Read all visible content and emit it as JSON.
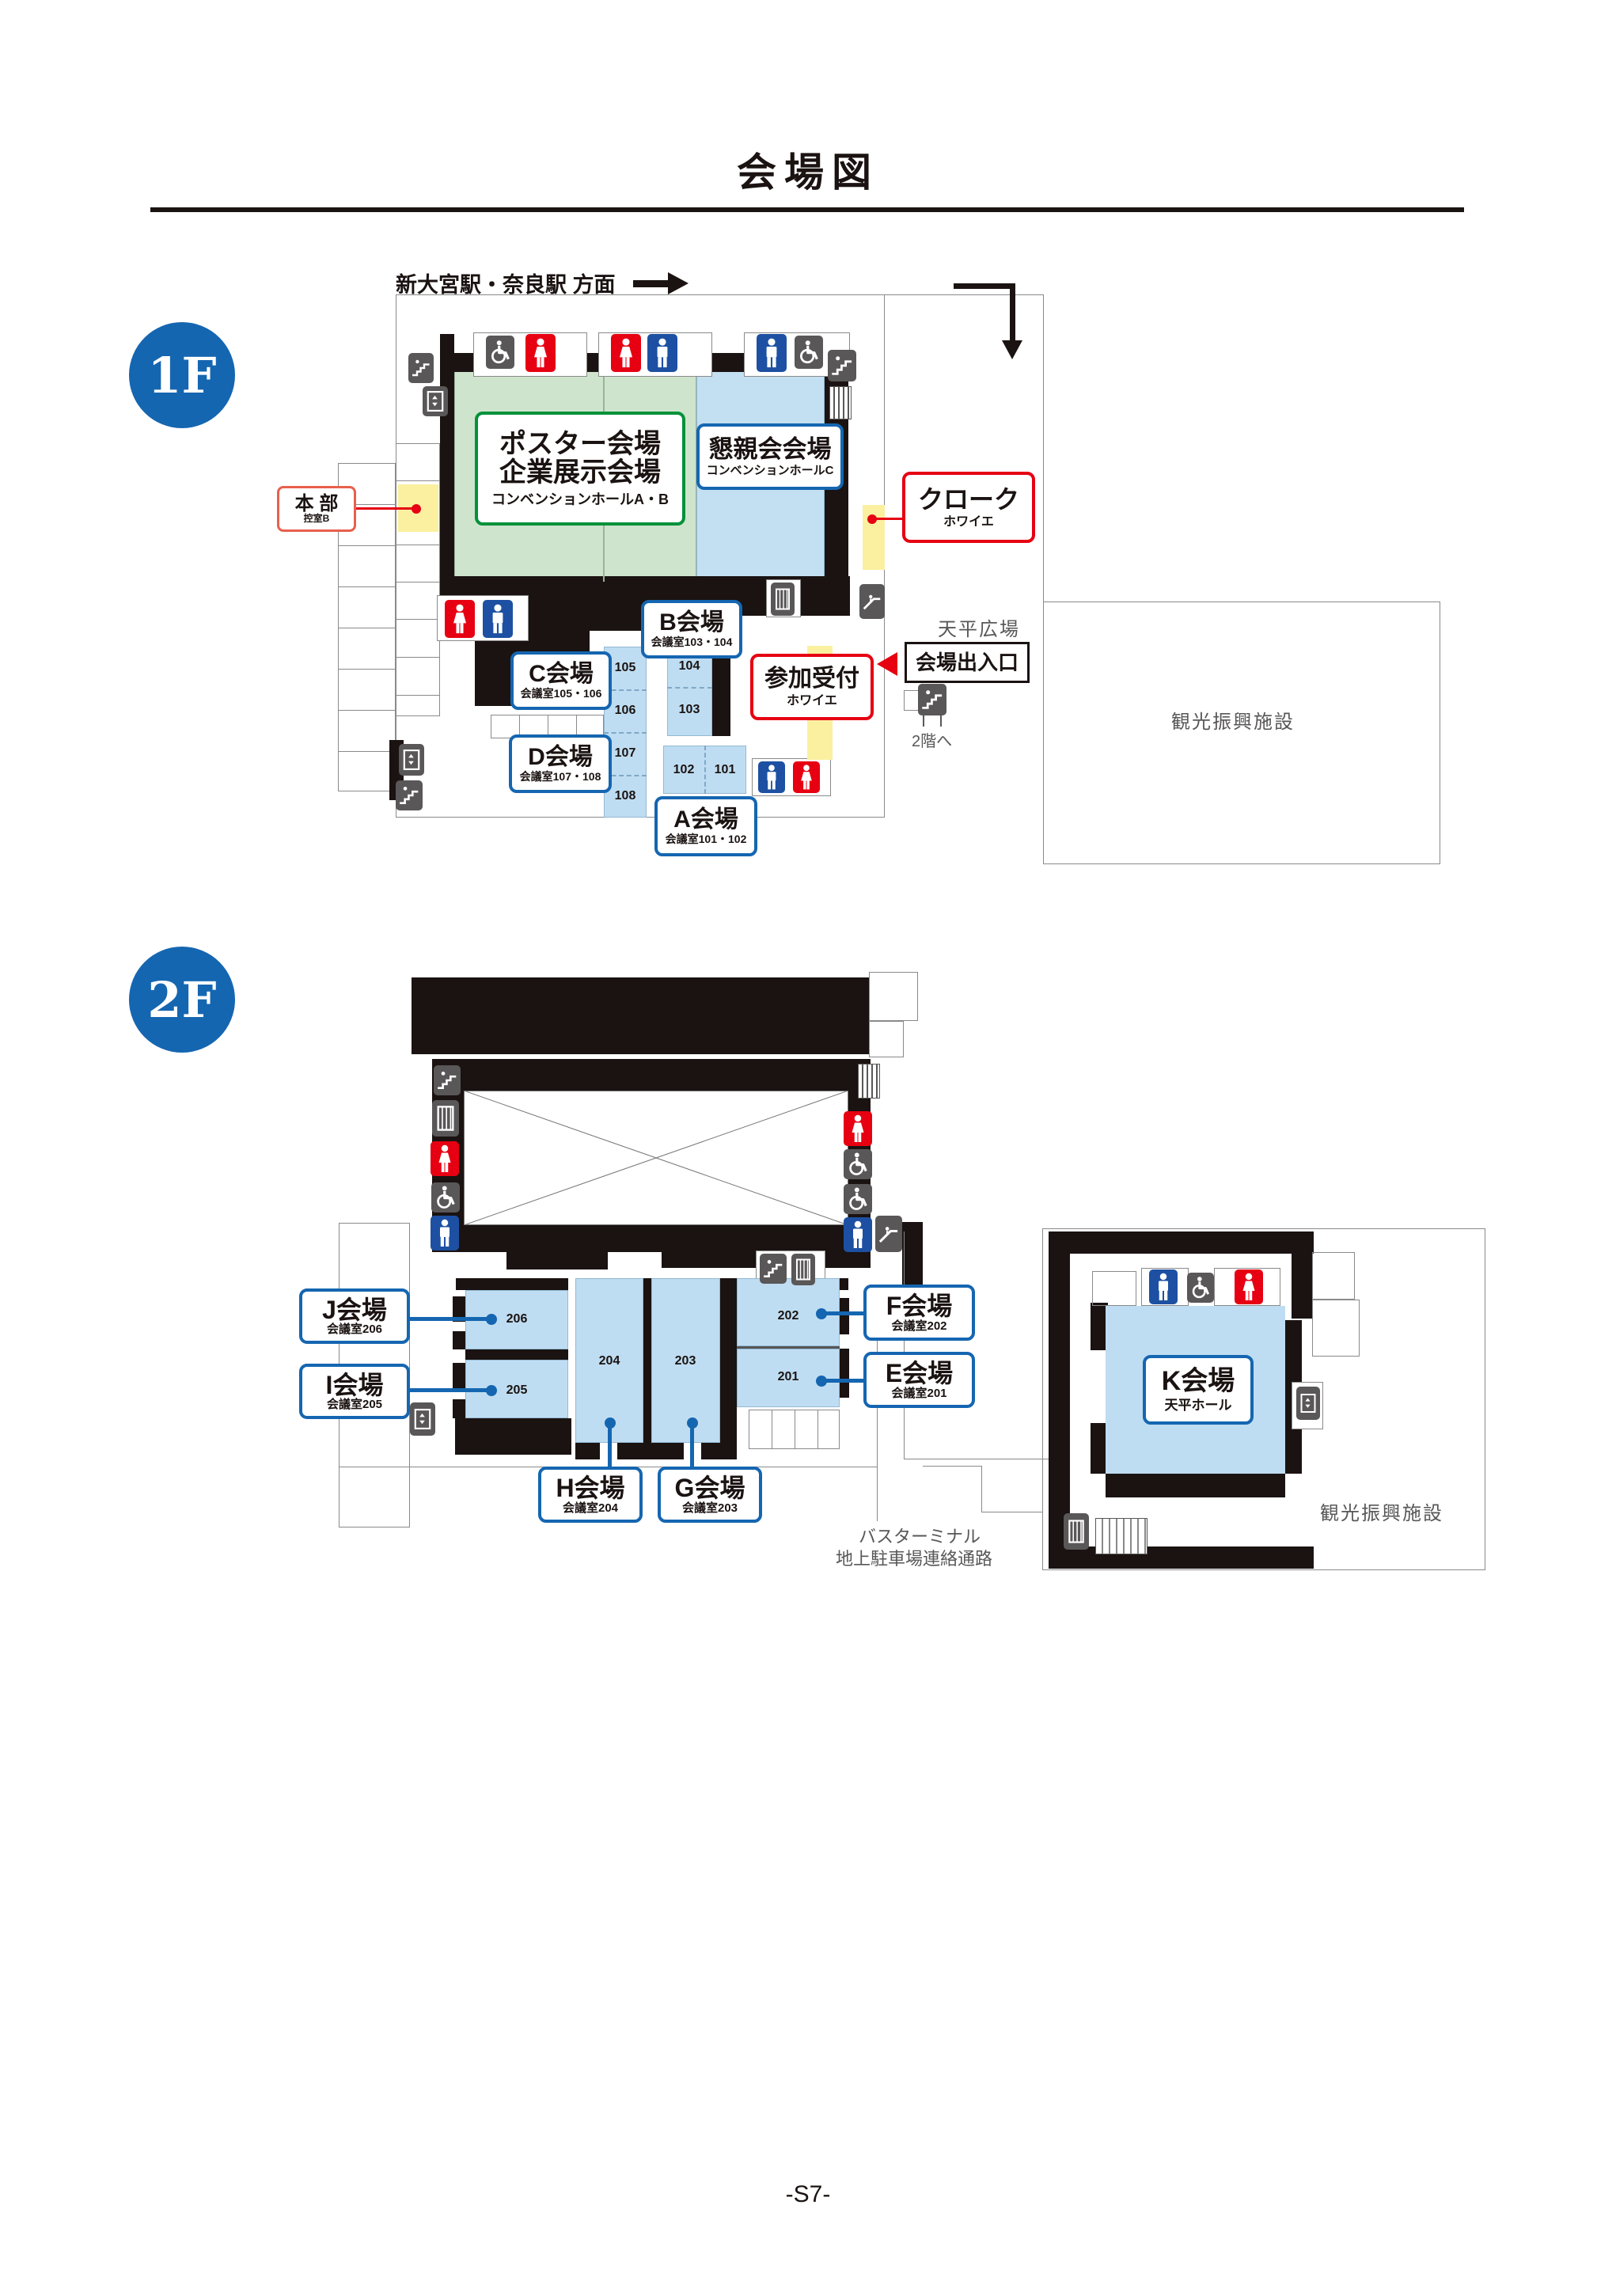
{
  "page": {
    "title": "会場図",
    "page_number": "-S7-"
  },
  "colors": {
    "accent_blue": "#1566b1",
    "accent_red": "#e60012",
    "accent_green": "#00913a",
    "hall_green": "#cfe4cc",
    "hall_blue": "#c3dff2",
    "room_blue": "#bfddf2",
    "wall_black": "#1a1311",
    "icon_gray": "#595757",
    "toilet_blue": "#1d50a2",
    "highlight_yellow": "#faf0a0"
  },
  "floor1": {
    "badge": "1F",
    "station_direction": "新大宮駅・奈良駅 方面",
    "to_2f": "2階へ",
    "plaza": "天平広場",
    "tourism": "観光振興施設",
    "halls": {
      "poster": {
        "line1": "ポスター会場",
        "line2": "企業展示会場",
        "sub": "コンベンションホールA・B"
      },
      "social": {
        "line1": "懇親会会場",
        "sub": "コンベンションホールC"
      }
    },
    "labels": {
      "honbu": {
        "main": "本 部",
        "sub": "控室B"
      },
      "cloak": {
        "main": "クローク",
        "sub": "ホワイエ"
      },
      "reception": {
        "main": "参加受付",
        "sub": "ホワイエ"
      },
      "entrance": "会場出入口"
    },
    "venues": [
      {
        "id": "A",
        "name": "A会場",
        "sub": "会議室101・102"
      },
      {
        "id": "B",
        "name": "B会場",
        "sub": "会議室103・104"
      },
      {
        "id": "C",
        "name": "C会場",
        "sub": "会議室105・106"
      },
      {
        "id": "D",
        "name": "D会場",
        "sub": "会議室107・108"
      }
    ],
    "rooms": [
      "101",
      "102",
      "103",
      "104",
      "105",
      "106",
      "107",
      "108"
    ]
  },
  "floor2": {
    "badge": "2F",
    "tourism": "観光振興施設",
    "bus_terminal": "バスターミナル",
    "parking_passage": "地上駐車場連絡通路",
    "venues": [
      {
        "id": "E",
        "name": "E会場",
        "sub": "会議室201"
      },
      {
        "id": "F",
        "name": "F会場",
        "sub": "会議室202"
      },
      {
        "id": "G",
        "name": "G会場",
        "sub": "会議室203"
      },
      {
        "id": "H",
        "name": "H会場",
        "sub": "会議室204"
      },
      {
        "id": "I",
        "name": "I会場",
        "sub": "会議室205"
      },
      {
        "id": "J",
        "name": "J会場",
        "sub": "会議室206"
      },
      {
        "id": "K",
        "name": "K会場",
        "sub": "天平ホール"
      }
    ],
    "rooms": [
      "201",
      "202",
      "203",
      "204",
      "205",
      "206"
    ]
  },
  "icons": {
    "men_toilet": "man-pictogram",
    "women_toilet": "woman-pictogram",
    "accessible": "wheelchair-pictogram",
    "stairs": "stairs-pictogram",
    "elevator": "elevator-pictogram",
    "escalator": "escalator-pictogram",
    "vending": "vending-machine-pictogram"
  }
}
